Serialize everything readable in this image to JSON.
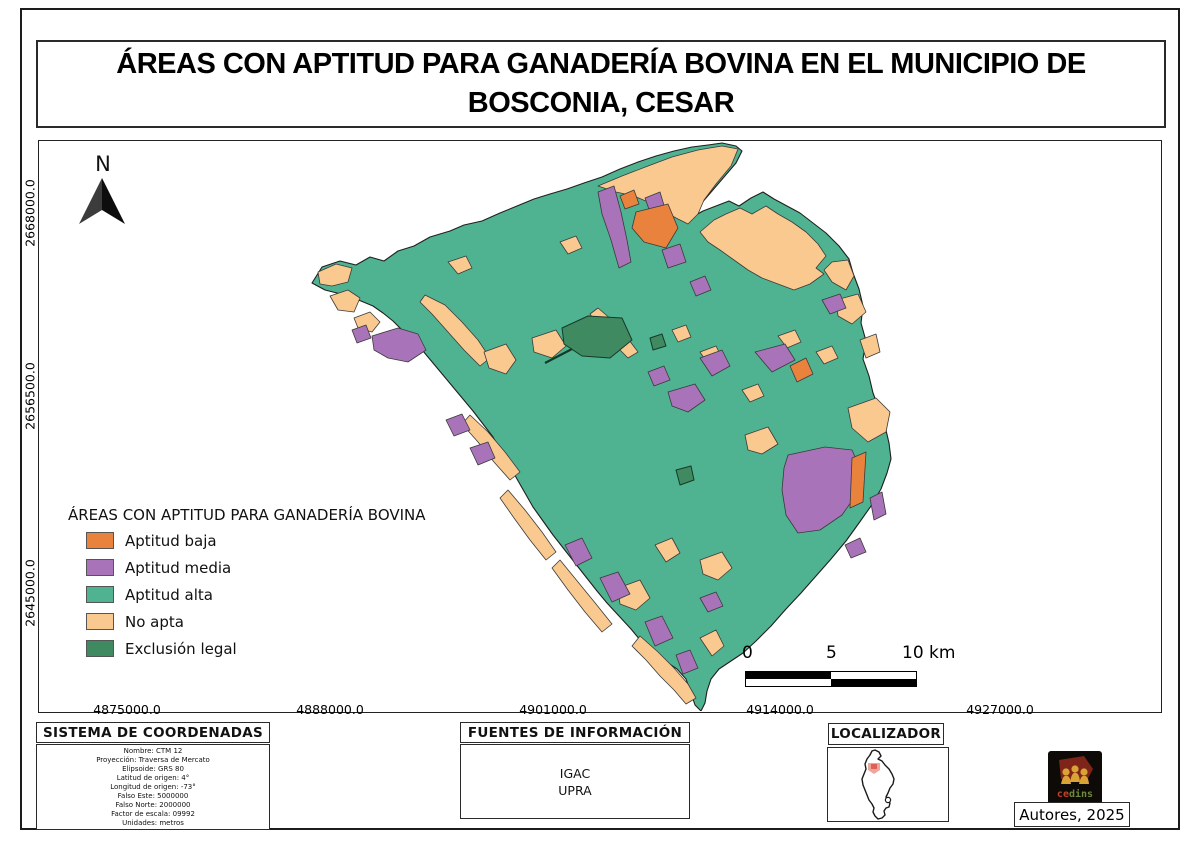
{
  "page": {
    "title_line1": "ÁREAS CON APTITUD PARA GANADERÍA BOVINA EN EL MUNICIPIO DE",
    "title_line2": "BOSCONIA, CESAR"
  },
  "map": {
    "north_label": "N",
    "y_axis_ticks": [
      "2668000.0",
      "2656500.0",
      "2645000.0"
    ],
    "x_axis_ticks": [
      "4875000.0",
      "4888000.0",
      "4901000.0",
      "4914000.0",
      "4927000.0"
    ],
    "legend": {
      "title": "ÁREAS CON APTITUD PARA GANADERÍA BOVINA",
      "items": [
        {
          "label": "Aptitud baja",
          "color": "#E8823C"
        },
        {
          "label": "Aptitud media",
          "color": "#A873B8"
        },
        {
          "label": "Aptitud alta",
          "color": "#4FB391"
        },
        {
          "label": "No apta",
          "color": "#F9C98F"
        },
        {
          "label": "Exclusión legal",
          "color": "#3F8A60"
        }
      ]
    },
    "scalebar": {
      "labels": [
        "0",
        "5",
        "10 km"
      ]
    }
  },
  "panels": {
    "coordinates": {
      "header": "SISTEMA DE COORDENADAS",
      "lines": [
        "Nombre: CTM 12",
        "Proyección: Traversa de Mercato",
        "Elipsoide: GRS 80",
        "Latitud de origen: 4°",
        "Longitud de origen: -73°",
        "Falso Este: 5000000",
        "Falso Norte: 2000000",
        "Factor de escala: 09992",
        "Unidades: metros"
      ]
    },
    "sources": {
      "header": "FUENTES DE INFORMACIÓN",
      "lines": [
        "IGAC",
        "UPRA"
      ]
    },
    "locator": {
      "header": "LOCALIZADOR"
    },
    "credits": {
      "logo_text_a": "ce",
      "logo_text_b": "dins",
      "authors": "Autores, 2025"
    }
  }
}
